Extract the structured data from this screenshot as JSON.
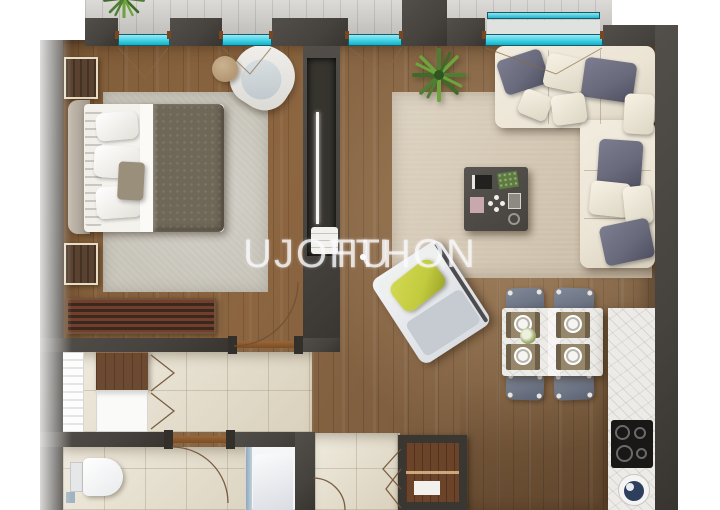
{
  "watermark": {
    "left": "UJOTTHON",
    "right": "HU",
    "dots": 3
  },
  "palette": {
    "wall": "#46423e",
    "window_glass": "#3ed2e6",
    "balcony_floor": "#c9c7c3",
    "wood_floor": "#8a6745",
    "tile_floor": "#e7e0cd",
    "rug_bedroom": "#c7c4ba",
    "rug_living": "#d4c7b2",
    "sofa": "#ece5d6",
    "pillow_slate": "#696a7c",
    "pillow_yellow": "#c2ca3d",
    "duvet": "#6f6757",
    "marble": "#edebe7",
    "chair": "#6e7585",
    "plant": "#5d8f3a",
    "sink_bowl": "#2e3f5e",
    "door_arc": "#6f5136"
  }
}
